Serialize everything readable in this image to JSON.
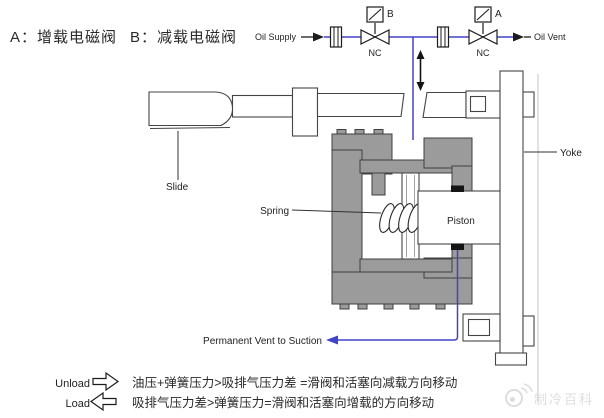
{
  "header": {
    "valve_a_legend": "A：增载电磁阀",
    "valve_b_legend": "B：减载电磁阀"
  },
  "schematic": {
    "oil_supply_label": "Oil Supply",
    "oil_vent_label": "Oil Vent",
    "solenoid_b": {
      "tag": "B",
      "state": "NC"
    },
    "solenoid_a": {
      "tag": "A",
      "state": "NC"
    }
  },
  "part_labels": {
    "slide": "Slide",
    "spring": "Spring",
    "piston": "Piston",
    "yoke": "Yoke",
    "permanent_vent": "Permanent Vent to Suction"
  },
  "legend": {
    "unload": {
      "label": "Unload",
      "rule": "油压+弹簧压力>吸排气压力差 =滑阀和活塞向减载方向移动"
    },
    "load": {
      "label": "Load",
      "rule": "吸排气压力差>弹簧压力=滑阀和活塞向增载的方向移动"
    }
  },
  "watermark": {
    "text": "制冷百科"
  },
  "icons": [
    "solenoid-coil-icon",
    "shutoff-valve-icon",
    "filter-orifice-icon",
    "flow-arrow-icon",
    "bidirectional-arrow-icon",
    "block-arrow-right-icon",
    "block-arrow-left-icon",
    "vent-arrow-icon",
    "weibo-logo-icon"
  ],
  "colors": {
    "hydraulic_line": "#4343c8",
    "body_fill": "#9b9b9b",
    "outline": "#3f3f3f",
    "watermark": "#d2d2d2"
  }
}
